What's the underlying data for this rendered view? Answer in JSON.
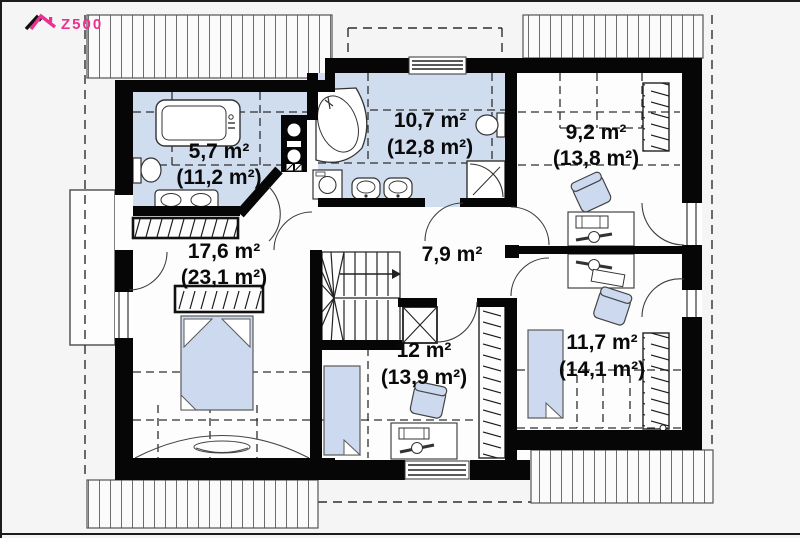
{
  "brand": "Z500",
  "colors": {
    "wall": "#060606",
    "room_highlight": "#cfddef",
    "furniture_highlight": "#cdd9ee",
    "logo_accent": "#e9328f",
    "background": "#f5f5f6",
    "drawing_line": "#3c3c3c",
    "label_text": "#0a0a0a"
  },
  "rooms": [
    {
      "id": "bathroom-small",
      "area": "5,7 m²",
      "total": "(11,2 m²)"
    },
    {
      "id": "bathroom-main",
      "area": "10,7 m²",
      "total": "(12,8 m²)"
    },
    {
      "id": "bedroom-top-right",
      "area": "9,2 m²",
      "total": "(13,8 m²)"
    },
    {
      "id": "bedroom-left",
      "area": "17,6 m²",
      "total": "(23,1 m²)"
    },
    {
      "id": "hallway",
      "area": "7,9 m²",
      "total": ""
    },
    {
      "id": "bedroom-bottom-middle",
      "area": "12 m²",
      "total": "(13,9 m²)"
    },
    {
      "id": "bedroom-bottom-right",
      "area": "11,7 m²",
      "total": "(14,1 m²)"
    }
  ]
}
